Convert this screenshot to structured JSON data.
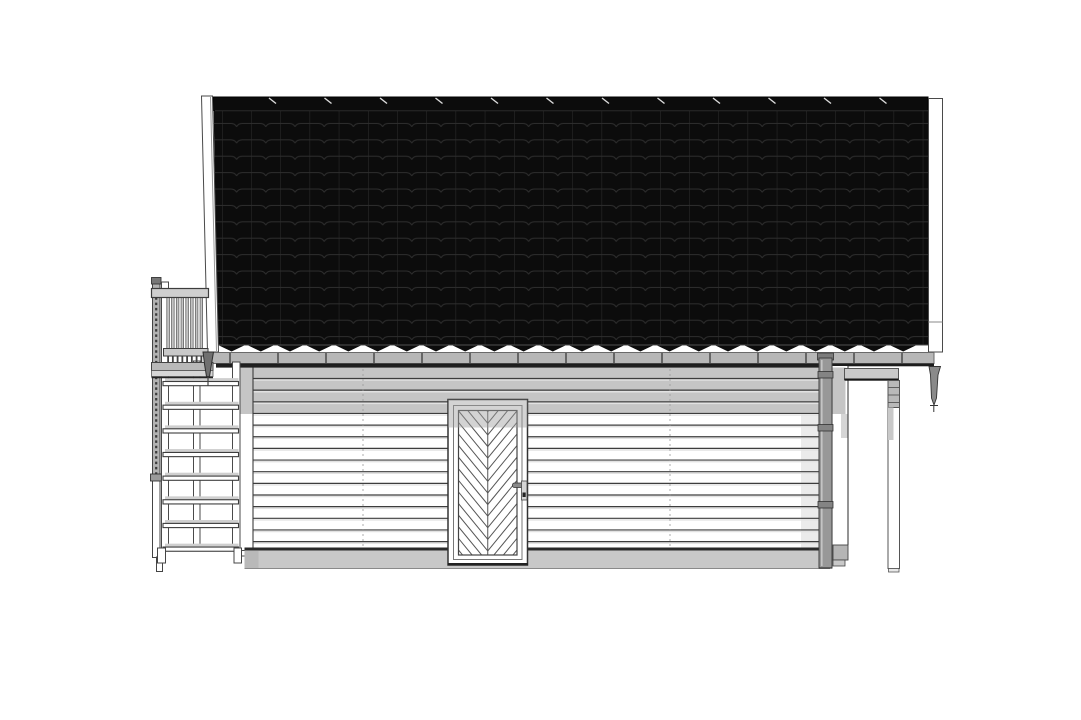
{
  "meta": {
    "type": "architectural-elevation",
    "view": "side-elevation",
    "description": "Side elevation drawing: gable roof with black interlocking tiles, white horizontal-siding facade, chevron-panel entrance door, external stair with balcony railing on the left, roof overhang with support post and downpipe on the right",
    "canvas": {
      "width": 1081,
      "height": 720
    },
    "visible_text": []
  },
  "palette": {
    "background": "#ffffff",
    "outline": "#3c3c3c",
    "roof_black": "#0c0c0c",
    "tile_line": "#2e2e2e",
    "ridge_gap": "#dcdcdc",
    "shadow_band": "#c5c5c5",
    "gutter": "#b7b7b7",
    "gutter_shadow": "#1c1c1c",
    "siding_line": "#3d3d3d",
    "plinth": "#c8c8c8",
    "plinth_edge": "#2a2a2a",
    "downpipe": "#989898",
    "door_line": "#555555",
    "bar_shadow": "#cfcfcf",
    "baluster": "#c3c3c3",
    "deck": "#b9b9b9",
    "beam": "#c9c9c9",
    "spout": "#707070"
  },
  "roof": {
    "left": 213.5,
    "right": 928,
    "top": 100,
    "eave": 345,
    "ridge_top": 97,
    "cap_width": 55.5,
    "notch_count": 12,
    "tile_col_width": 29.2,
    "tile_row_height": 16.4,
    "tip_depth": 7,
    "tip_count": 24,
    "tip_start": 217
  },
  "gutter": {
    "left": 212,
    "right": 934,
    "top": 352.5,
    "height": 11,
    "bracket_start": 230,
    "bracket_gap": 48,
    "bracket_end": 925
  },
  "siding": {
    "left": 253,
    "right": 819,
    "first_y": 378.5,
    "gap": 11.65,
    "count": 15,
    "seams": [
      363,
      670
    ]
  },
  "stairs": {
    "bars": {
      "count": 8,
      "left": 163,
      "width": 75.5,
      "first_y": 381.5,
      "gap": 23.65,
      "height": 4.2
    }
  },
  "balcony": {
    "balusters": {
      "count": 8,
      "first_x": 166.8,
      "gap": 4.75,
      "width": 2.6,
      "top": 297.5,
      "bottom": 348.5,
      "tick_top": 356.5,
      "tick_bottom": 362
    }
  },
  "door": {
    "chevron": {
      "gap": 11.6,
      "rise": 35.7,
      "first_t": 376,
      "last_t": 556,
      "center_x": 487.75,
      "left": 458.5,
      "right": 517,
      "panel_top": 410.5,
      "panel_bottom": 555
    }
  },
  "downpipe": {
    "collar_ys": [
      371.5,
      424.5,
      501.5
    ]
  }
}
